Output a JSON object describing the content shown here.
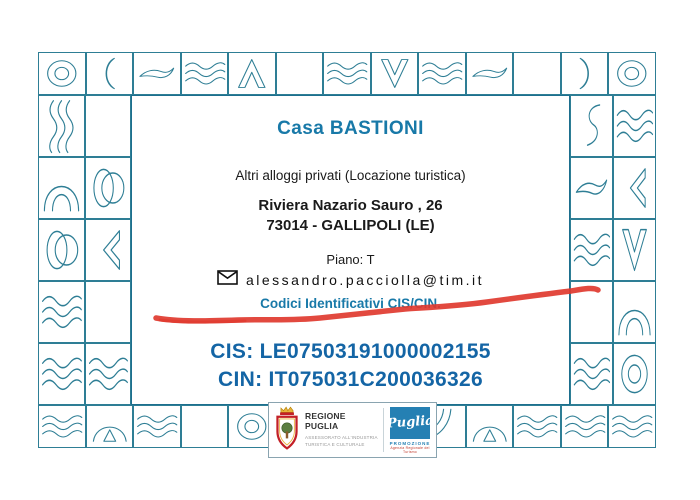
{
  "content": {
    "title": "Casa BASTIONI",
    "subtitle": "Altri alloggi privati (Locazione turistica)",
    "address_line1": "Riviera Nazario Sauro , 26",
    "address_line2": "73014 - GALLIPOLI (LE)",
    "floor": "Piano: T",
    "email": "alessandro.pacciolla@tim.it",
    "codes_heading": "Codici Identificativi CIS/CIN.",
    "cis_code": "CIS: LE07503191000002155",
    "cin_code": "CIN: IT075031C200036326"
  },
  "footer": {
    "region_name": "REGIONE PUGLIA",
    "region_dept_line1": "ASSESSORATO ALL'INDUSTRIA",
    "region_dept_line2": "TURISTICA E CULTURALE",
    "promo_script": "Puglia",
    "promo_name": "PROMOZIONE",
    "promo_sub": "Agenzia Regionale del Turismo"
  },
  "colors": {
    "accent_teal": "#1879a8",
    "code_blue": "#1465a5",
    "border_teal": "#2e7e95",
    "scribble_red": "#e03a2f",
    "promo_blue": "#2580b3"
  },
  "icons": {
    "email_icon": "envelope-icon",
    "region_icon": "regione-puglia-crest-icon",
    "scribble": "red-underline-scribble"
  },
  "border": {
    "top": [
      "donut",
      "arc-left",
      "smile",
      "waves",
      "chevron-up",
      "blank",
      "waves",
      "vee",
      "waves",
      "smile",
      "blank",
      "crescent-right",
      "donut"
    ],
    "bottom": [
      "waves",
      "mountain",
      "waves",
      "blank",
      "donut",
      "blank",
      "blank",
      "blank",
      "arcs",
      "mountain",
      "waves",
      "waves",
      "waves"
    ],
    "left_outer": [
      "vwaves",
      "dome",
      "circle",
      "waves",
      "waves"
    ],
    "left_inner": [
      "blank",
      "circle",
      "chevron-left",
      "blank",
      "waves"
    ],
    "right_inner": [
      "curl",
      "smile",
      "waves",
      "blank",
      "waves"
    ],
    "right_outer": [
      "waves",
      "chevron-left",
      "vee",
      "dome",
      "donut"
    ]
  }
}
